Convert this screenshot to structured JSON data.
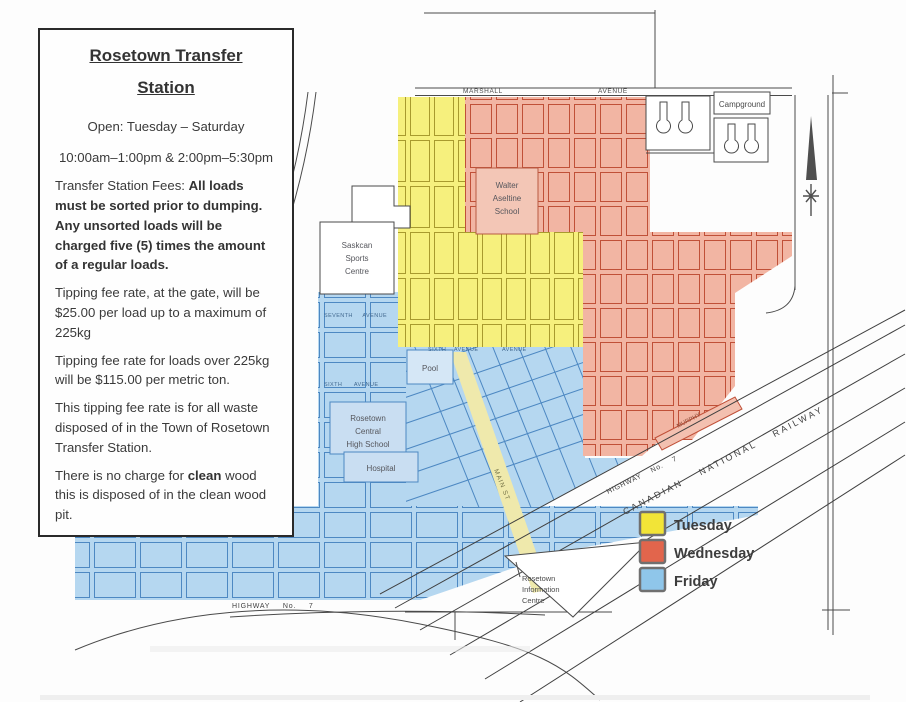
{
  "info_box": {
    "title_line1": "Rosetown Transfer",
    "title_line2": "Station",
    "open_line": "Open: Tuesday – Saturday",
    "hours_line": "10:00am–1:00pm & 2:00pm–5:30pm",
    "fees_prefix": "Transfer Station Fees: ",
    "fees_bold": "All loads must be sorted prior to dumping. Any unsorted loads will be charged five (5) times the amount of a regular loads.",
    "tipping_rate_1": "Tipping fee rate, at the gate, will be $25.00 per load up to a maximum of 225kg",
    "tipping_rate_2": "Tipping fee rate for loads over 225kg will be $115.00 per metric ton.",
    "tipping_scope": "This tipping fee rate is for all waste disposed of in the Town of Rosetown Transfer Station.",
    "clean_wood_prefix": "There is no charge for ",
    "clean_wood_bold": "clean",
    "clean_wood_suffix": " wood this is disposed of in the clean wood pit."
  },
  "map": {
    "labels": {
      "marshall": "MARSHALL",
      "avenue": "AVENUE",
      "campground": "Campground",
      "school_1": "Walter",
      "school_2": "Aseltine",
      "school_3": "School",
      "sports_1": "Saskcan",
      "sports_2": "Sports",
      "sports_3": "Centre",
      "pool": "Pool",
      "high_school_1": "Rosetown",
      "high_school_2": "Central",
      "high_school_3": "High School",
      "hospital": "Hospital",
      "info_centre_1": "Rosetown",
      "info_centre_2": "Information",
      "info_centre_3": "Centre",
      "seventh_avenue": "SEVENTH AVENUE",
      "sixth_avenue": "SIXTH AVENUE",
      "main_st": "MAIN ST",
      "murphy": "MURPHY",
      "railway": "CANADIAN NATIONAL RAILWAY",
      "highway_diag": "HIGHWAY No. 7",
      "highway_bottom": "HIGHWAY No. 7"
    },
    "legend": {
      "items": [
        {
          "label": "Tuesday",
          "color": "#f2e437"
        },
        {
          "label": "Wednesday",
          "color": "#e2654c"
        },
        {
          "label": "Friday",
          "color": "#8fc6ea"
        }
      ]
    },
    "zone_colors": {
      "tuesday": "#f6f07d",
      "wednesday": "#f2b5a3",
      "friday": "#b5d7f0"
    }
  }
}
